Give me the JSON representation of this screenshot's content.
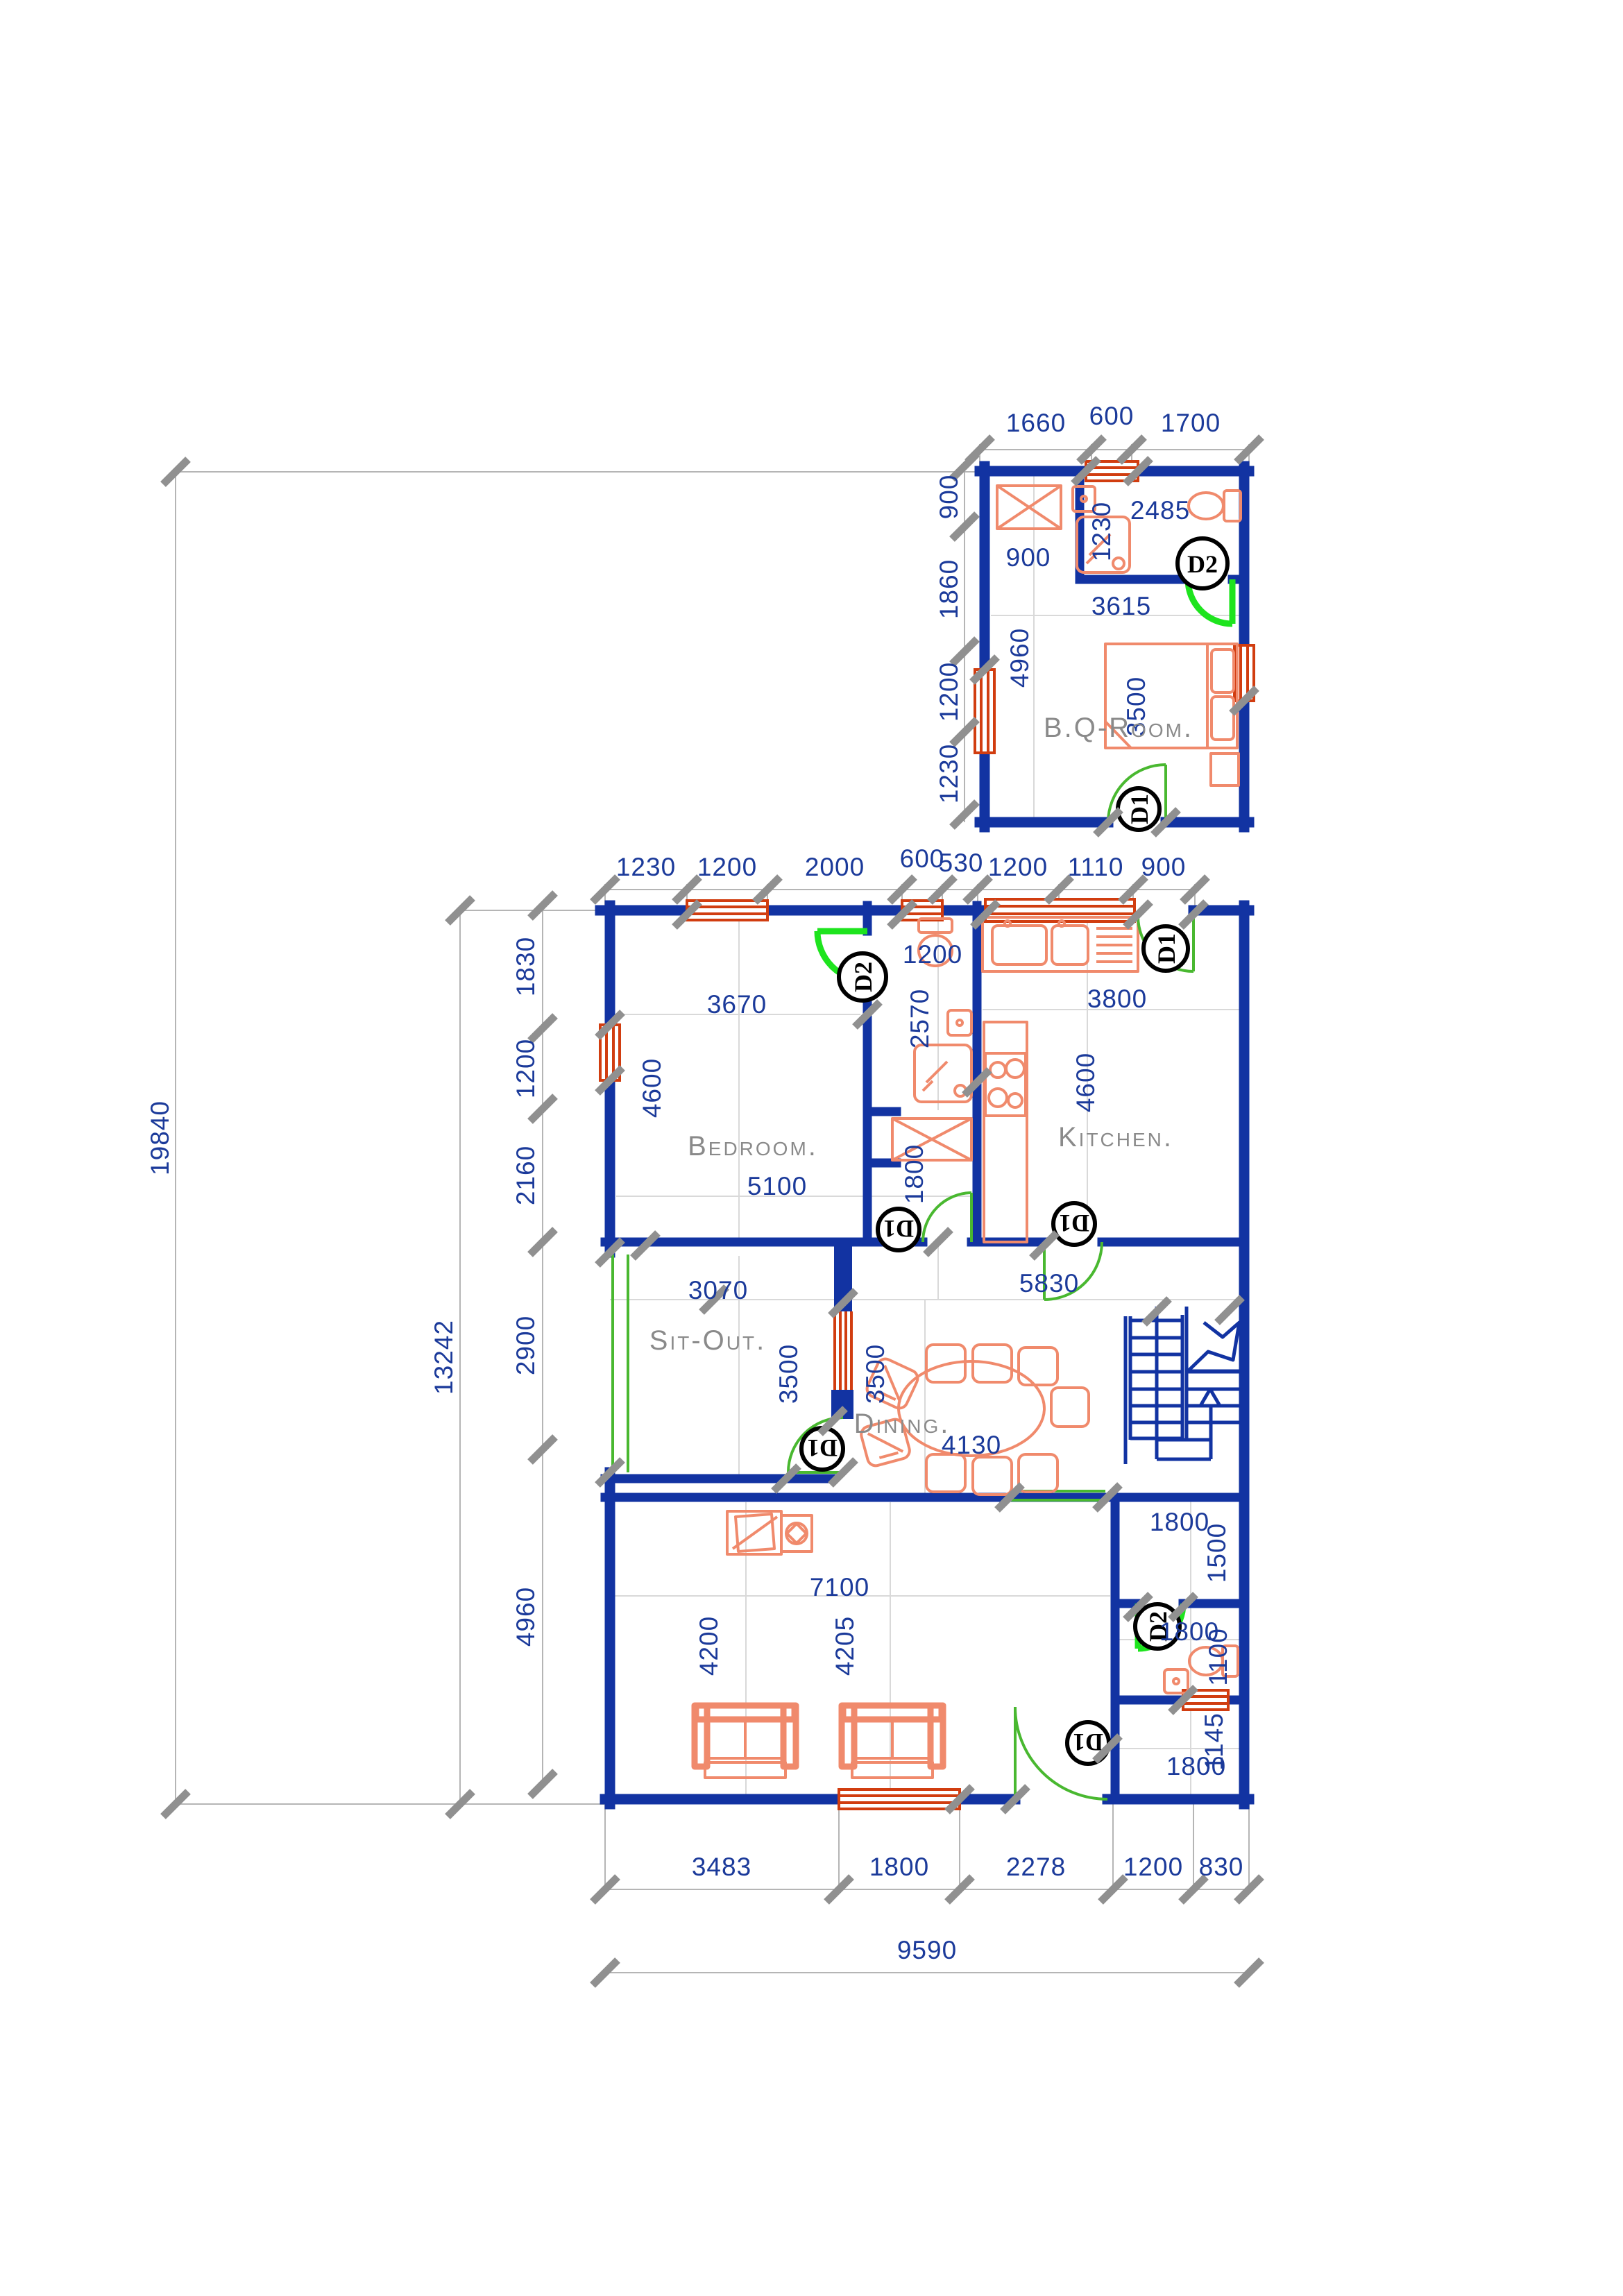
{
  "colors": {
    "wall": "#1233a2",
    "fixture": "#f08a6c",
    "window": "#d13d10",
    "door": "#49b830",
    "door2": "#1ee41e",
    "dim": "#1b3a9a",
    "label": "#8a8a8a",
    "tick": "#909090",
    "dimline": "#b5b5b5"
  },
  "rooms": {
    "bq": "B.Q-Room.",
    "bedroom": "Bedroom.",
    "kitchen": "Kitchen.",
    "sitout": "Sit-Out.",
    "dining": "Dining."
  },
  "door_tags": [
    {
      "label": "D2"
    },
    {
      "label": "D1"
    },
    {
      "label": "D2"
    },
    {
      "label": "D1"
    },
    {
      "label": "D1"
    },
    {
      "label": "D1"
    },
    {
      "label": "D1"
    },
    {
      "label": "D2"
    },
    {
      "label": "D1"
    }
  ],
  "dims": {
    "annex_top": [
      "1660",
      "600",
      "1700"
    ],
    "annex_left": [
      "900",
      "1860",
      "1200",
      "1230"
    ],
    "annex_in": [
      "2485",
      "1230",
      "900",
      "3615",
      "4960",
      "3500"
    ],
    "top_row": [
      "1230",
      "1200",
      "2000",
      "600",
      "530",
      "1200",
      "1110",
      "900"
    ],
    "left_outer": [
      "19840",
      "13242"
    ],
    "left_col": [
      "1830",
      "1200",
      "2160",
      "2900",
      "4960"
    ],
    "bedroom": [
      "3670",
      "4600",
      "5100"
    ],
    "bath1": [
      "1200",
      "2570",
      "1800"
    ],
    "kitchen": [
      "3800",
      "4600"
    ],
    "sitout": [
      "3070",
      "3500"
    ],
    "dining": [
      "3500",
      "5830",
      "4130"
    ],
    "living": [
      "7100",
      "4200",
      "4205"
    ],
    "store": [
      "1800",
      "1500"
    ],
    "bath2": [
      "1800",
      "1100"
    ],
    "porch": [
      "1800",
      "1145"
    ],
    "bottom_row": [
      "3483",
      "1800",
      "2278",
      "1200",
      "830"
    ],
    "bottom_total": [
      "9590"
    ]
  }
}
